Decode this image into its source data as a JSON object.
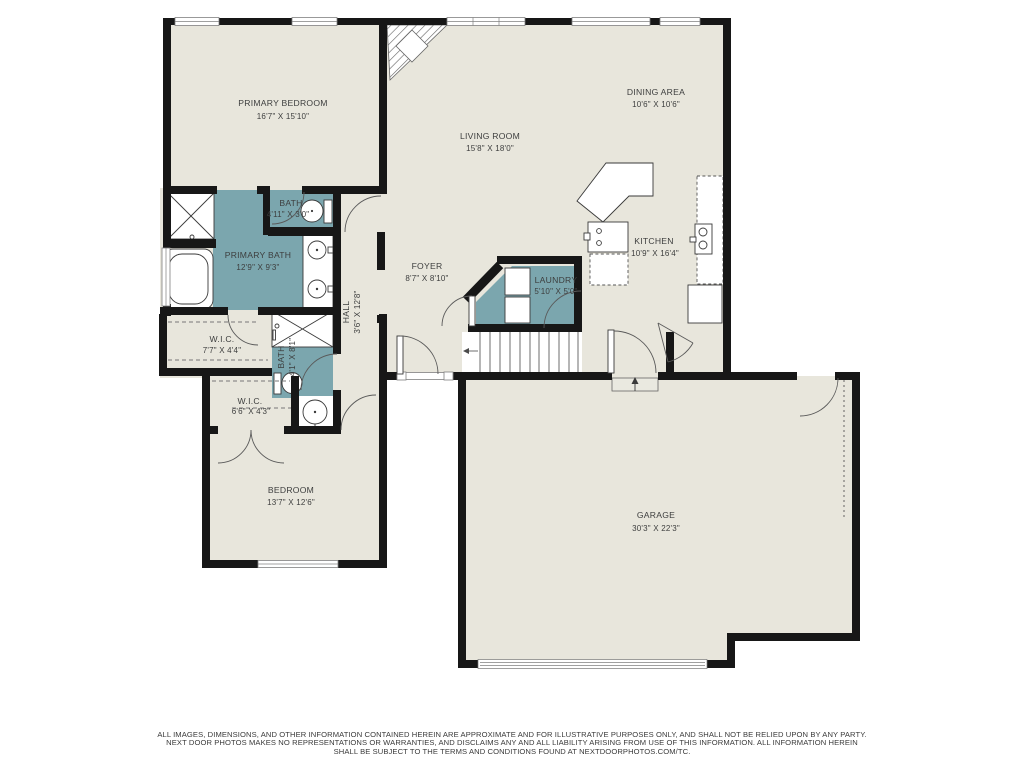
{
  "plan": {
    "title": "Floor plan",
    "rooms": [
      {
        "name": "PRIMARY BEDROOM",
        "dims": "16'7\" X 15'10\""
      },
      {
        "name": "BATH",
        "dims": "4'11\" X 3'0\""
      },
      {
        "name": "PRIMARY BATH",
        "dims": "12'9\" X 9'3\""
      },
      {
        "name": "W.I.C.",
        "dims": "7'7\" X 4'4\""
      },
      {
        "name": "BATH",
        "dims": "4'1\" X 8'1\""
      },
      {
        "name": "W.I.C.",
        "dims": "6'6\" X 4'3\""
      },
      {
        "name": "BEDROOM",
        "dims": "13'7\" X 12'6\""
      },
      {
        "name": "HALL",
        "dims": "3'6\" X 12'8\""
      },
      {
        "name": "FOYER",
        "dims": "8'7\" X 8'10\""
      },
      {
        "name": "LIVING ROOM",
        "dims": "15'8\" X 18'0\""
      },
      {
        "name": "DINING AREA",
        "dims": "10'6\" X 10'6\""
      },
      {
        "name": "KITCHEN",
        "dims": "10'9\" X 16'4\""
      },
      {
        "name": "LAUNDRY",
        "dims": "5'10\" X 5'0\""
      },
      {
        "name": "GARAGE",
        "dims": "30'3\" X 22'3\""
      }
    ],
    "colors": {
      "floor": "#e8e6dc",
      "bath_floor": "#7ba6ae",
      "wall": "#171717",
      "text": "#3d3e3e"
    },
    "disclaimer": {
      "line1": "ALL IMAGES, DIMENSIONS, AND OTHER INFORMATION CONTAINED HEREIN ARE APPROXIMATE AND FOR ILLUSTRATIVE PURPOSES ONLY, AND SHALL NOT BE RELIED UPON BY ANY PARTY.",
      "line2": "NEXT DOOR PHOTOS MAKES NO REPRESENTATIONS OR WARRANTIES, AND DISCLAIMS ANY AND ALL LIABILITY ARISING FROM USE OF THIS INFORMATION. ALL INFORMATION HEREIN",
      "line3": "SHALL BE SUBJECT TO THE TERMS AND CONDITIONS FOUND AT NEXTDOORPHOTOS.COM/TC."
    }
  }
}
